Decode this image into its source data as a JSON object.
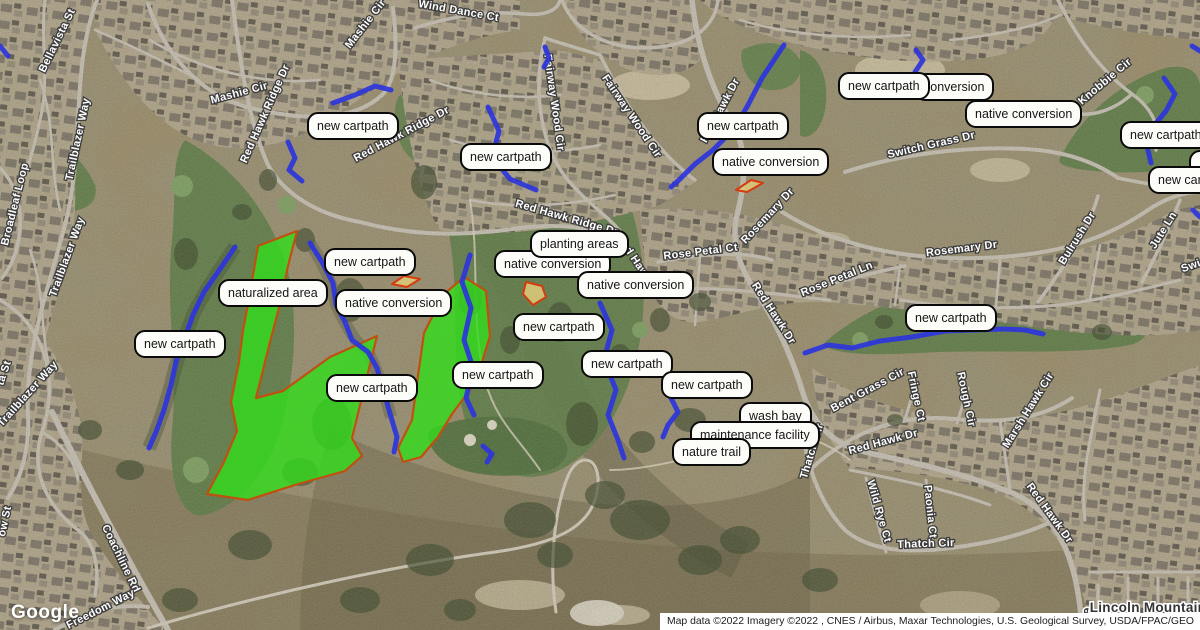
{
  "map": {
    "logo": "Google",
    "attribution": "Map data ©2022 Imagery ©2022 , CNES / Airbus, Maxar Technologies, U.S. Geological Survey, USDA/FPAC/GEO",
    "colors": {
      "annotation_green": "#32dd1c",
      "annotation_border": "#c05010",
      "planting_tan": "#d9c878",
      "cartpath_blue": "#2c35dc",
      "label_background": "#fcfcf8",
      "label_border": "#0a0a0a"
    },
    "overlay_labels": [
      {
        "text": "new cartpath",
        "x": 307,
        "y": 112
      },
      {
        "text": "new cartpath",
        "x": 460,
        "y": 143
      },
      {
        "text": "new cartpath",
        "x": 697,
        "y": 112
      },
      {
        "text": "native conversion",
        "x": 712,
        "y": 148
      },
      {
        "text": "conversion",
        "x": 914,
        "y": 73
      },
      {
        "text": "new cartpath",
        "x": 838,
        "y": 72
      },
      {
        "text": "native conversion",
        "x": 965,
        "y": 100
      },
      {
        "text": "",
        "x": 1189,
        "y": 150,
        "w": 34,
        "h": 14
      },
      {
        "text": "new cartpath",
        "x": 1120,
        "y": 121
      },
      {
        "text": "new cartpath",
        "x": 1148,
        "y": 166
      },
      {
        "text": "native conversion",
        "x": 494,
        "y": 250
      },
      {
        "text": "planting areas",
        "x": 530,
        "y": 230
      },
      {
        "text": "native conversion",
        "x": 577,
        "y": 271
      },
      {
        "text": "naturalized area",
        "x": 218,
        "y": 279
      },
      {
        "text": "new cartpath",
        "x": 324,
        "y": 248
      },
      {
        "text": "native conversion",
        "x": 335,
        "y": 289
      },
      {
        "text": "new cartpath",
        "x": 134,
        "y": 330
      },
      {
        "text": "new cartpath",
        "x": 326,
        "y": 374
      },
      {
        "text": "new cartpath",
        "x": 452,
        "y": 361
      },
      {
        "text": "new cartpath",
        "x": 513,
        "y": 313
      },
      {
        "text": "new cartpath",
        "x": 581,
        "y": 350
      },
      {
        "text": "new cartpath",
        "x": 661,
        "y": 371
      },
      {
        "text": "new cartpath",
        "x": 905,
        "y": 304
      },
      {
        "text": "wash bay",
        "x": 739,
        "y": 402
      },
      {
        "text": "maintenance facility",
        "x": 690,
        "y": 421
      },
      {
        "text": "nature trail",
        "x": 672,
        "y": 438
      }
    ],
    "streets": [
      {
        "name": "Bellavista St",
        "x": 60,
        "y": 42,
        "rot": -64
      },
      {
        "name": "Mashie Cir",
        "x": 368,
        "y": 26,
        "rot": -52
      },
      {
        "name": "Wind Dance Ct",
        "x": 458,
        "y": 14,
        "rot": 10
      },
      {
        "name": "Mashie Cir",
        "x": 240,
        "y": 96,
        "rot": -15
      },
      {
        "name": "Red Hawk Ridge Dr",
        "x": 268,
        "y": 115,
        "rot": -66
      },
      {
        "name": "Red Hawk Ridge Dr",
        "x": 403,
        "y": 137,
        "rot": -28
      },
      {
        "name": "Trailblazer Way",
        "x": 81,
        "y": 140,
        "rot": -78
      },
      {
        "name": "Broadleaf Loop",
        "x": 18,
        "y": 205,
        "rot": -76
      },
      {
        "name": "Trailblazer Way",
        "x": 70,
        "y": 258,
        "rot": -70
      },
      {
        "name": "Trailblazer Way",
        "x": 30,
        "y": 396,
        "rot": -48
      },
      {
        "name": "ta St",
        "x": 7,
        "y": 374,
        "rot": -72
      },
      {
        "name": "Fairway Wood Cir",
        "x": 551,
        "y": 103,
        "rot": 82
      },
      {
        "name": "Fairway Wood Cir",
        "x": 629,
        "y": 118,
        "rot": 56
      },
      {
        "name": "Red Hawk Dr",
        "x": 723,
        "y": 112,
        "rot": -62
      },
      {
        "name": "Switch Grass Dr",
        "x": 932,
        "y": 148,
        "rot": -13
      },
      {
        "name": "Knobbie Cir",
        "x": 1107,
        "y": 84,
        "rot": -40
      },
      {
        "name": "Red Hawk Ridge Dr",
        "x": 566,
        "y": 221,
        "rot": 16
      },
      {
        "name": "Red Hawk Dr",
        "x": 636,
        "y": 267,
        "rot": 56
      },
      {
        "name": "Rose Petal Ct",
        "x": 701,
        "y": 255,
        "rot": -7
      },
      {
        "name": "Rosemary Dr",
        "x": 770,
        "y": 218,
        "rot": -47
      },
      {
        "name": "Red Hawk Dr",
        "x": 771,
        "y": 315,
        "rot": 57
      },
      {
        "name": "Rose Petal Ln",
        "x": 838,
        "y": 282,
        "rot": -22
      },
      {
        "name": "Rosemary Dr",
        "x": 962,
        "y": 252,
        "rot": -7
      },
      {
        "name": "Bulrush Dr",
        "x": 1080,
        "y": 240,
        "rot": -58
      },
      {
        "name": "Jute Ln",
        "x": 1166,
        "y": 232,
        "rot": -58
      },
      {
        "name": "Swi",
        "x": 1192,
        "y": 269,
        "rot": -20
      },
      {
        "name": "Bent Grass Cir",
        "x": 869,
        "y": 393,
        "rot": -28
      },
      {
        "name": "Fringe Ct",
        "x": 913,
        "y": 397,
        "rot": 78
      },
      {
        "name": "Rough Cir",
        "x": 963,
        "y": 400,
        "rot": 78
      },
      {
        "name": "Marsh Hawk Cir",
        "x": 1031,
        "y": 412,
        "rot": -58
      },
      {
        "name": "Thatch Cir",
        "x": 815,
        "y": 452,
        "rot": -73
      },
      {
        "name": "Red Hawk Dr",
        "x": 884,
        "y": 445,
        "rot": -15
      },
      {
        "name": "Wild Rye Ct",
        "x": 876,
        "y": 512,
        "rot": 74
      },
      {
        "name": "Paonia Ct",
        "x": 927,
        "y": 512,
        "rot": 84
      },
      {
        "name": "Thatch Cir",
        "x": 926,
        "y": 547,
        "rot": -2
      },
      {
        "name": "Red Hawk Dr",
        "x": 1047,
        "y": 515,
        "rot": 54
      },
      {
        "name": "Re",
        "x": 1090,
        "y": 617,
        "rot": -78,
        "style": "major"
      },
      {
        "name": "Lincoln Mountain D",
        "x": 1155,
        "y": 612,
        "rot": 0,
        "style": "major"
      },
      {
        "name": "Coachline Rd",
        "x": 118,
        "y": 560,
        "rot": 64
      },
      {
        "name": "ow St",
        "x": 8,
        "y": 522,
        "rot": -78
      },
      {
        "name": "Freedom Way",
        "x": 102,
        "y": 612,
        "rot": -27
      }
    ],
    "annotations": {
      "areas": [
        {
          "type": "naturalized",
          "points": [
            258,
            246,
            297,
            231,
            288,
            266,
            281,
            300,
            270,
            342,
            261,
            378,
            256,
            398,
            283,
            391,
            330,
            357,
            377,
            336,
            352,
            438,
            362,
            456,
            345,
            471,
            298,
            484,
            248,
            500,
            207,
            494,
            224,
            462,
            237,
            431,
            231,
            402,
            239,
            362,
            243,
            330,
            249,
            299
          ]
        },
        {
          "type": "naturalized",
          "points": [
            464,
            277,
            486,
            291,
            490,
            336,
            482,
            362,
            470,
            390,
            452,
            414,
            438,
            437,
            421,
            457,
            403,
            462,
            398,
            448,
            412,
            420,
            418,
            376,
            424,
            333,
            443,
            295
          ]
        },
        {
          "type": "planting",
          "points": [
            392,
            284,
            404,
            276,
            420,
            279,
            407,
            287
          ]
        },
        {
          "type": "planting",
          "points": [
            526,
            282,
            542,
            286,
            546,
            297,
            533,
            305,
            523,
            294
          ]
        },
        {
          "type": "planting",
          "points": [
            736,
            190,
            751,
            180,
            763,
            183,
            747,
            192
          ]
        }
      ],
      "cartpaths": [
        [
          288,
          142,
          295,
          158,
          289,
          170,
          302,
          181
        ],
        [
          333,
          103,
          355,
          95,
          375,
          86,
          391,
          90
        ],
        [
          488,
          107,
          499,
          131,
          492,
          157,
          510,
          179,
          536,
          190
        ],
        [
          784,
          45,
          762,
          78,
          748,
          105,
          735,
          128,
          713,
          150,
          695,
          164,
          679,
          180,
          671,
          187
        ],
        [
          916,
          50,
          923,
          60,
          915,
          72
        ],
        [
          1164,
          78,
          1175,
          94,
          1166,
          111,
          1152,
          128,
          1147,
          146,
          1151,
          163
        ],
        [
          235,
          247,
          218,
          272,
          204,
          292,
          193,
          315,
          184,
          340,
          176,
          362,
          171,
          385,
          164,
          410,
          156,
          432,
          149,
          448
        ],
        [
          310,
          243,
          322,
          262,
          333,
          283,
          336,
          305,
          345,
          322,
          352,
          340,
          368,
          352,
          377,
          368,
          384,
          392,
          391,
          417,
          397,
          437,
          394,
          452
        ],
        [
          470,
          255,
          462,
          282,
          471,
          308,
          464,
          340,
          473,
          368,
          466,
          398,
          474,
          415
        ],
        [
          600,
          303,
          612,
          330,
          604,
          360,
          616,
          390,
          608,
          415,
          618,
          440,
          624,
          458
        ],
        [
          671,
          398,
          678,
          412,
          668,
          425,
          663,
          437
        ],
        [
          805,
          353,
          828,
          345,
          852,
          348,
          880,
          341,
          912,
          337,
          945,
          331,
          975,
          330,
          1005,
          329,
          1025,
          330,
          1043,
          334
        ],
        [
          545,
          47,
          549,
          58,
          544,
          67
        ],
        [
          0,
          46,
          8,
          56
        ],
        [
          1192,
          46,
          1200,
          51
        ],
        [
          1193,
          210,
          1200,
          217
        ],
        [
          483,
          446,
          492,
          454,
          487,
          462
        ]
      ]
    }
  }
}
